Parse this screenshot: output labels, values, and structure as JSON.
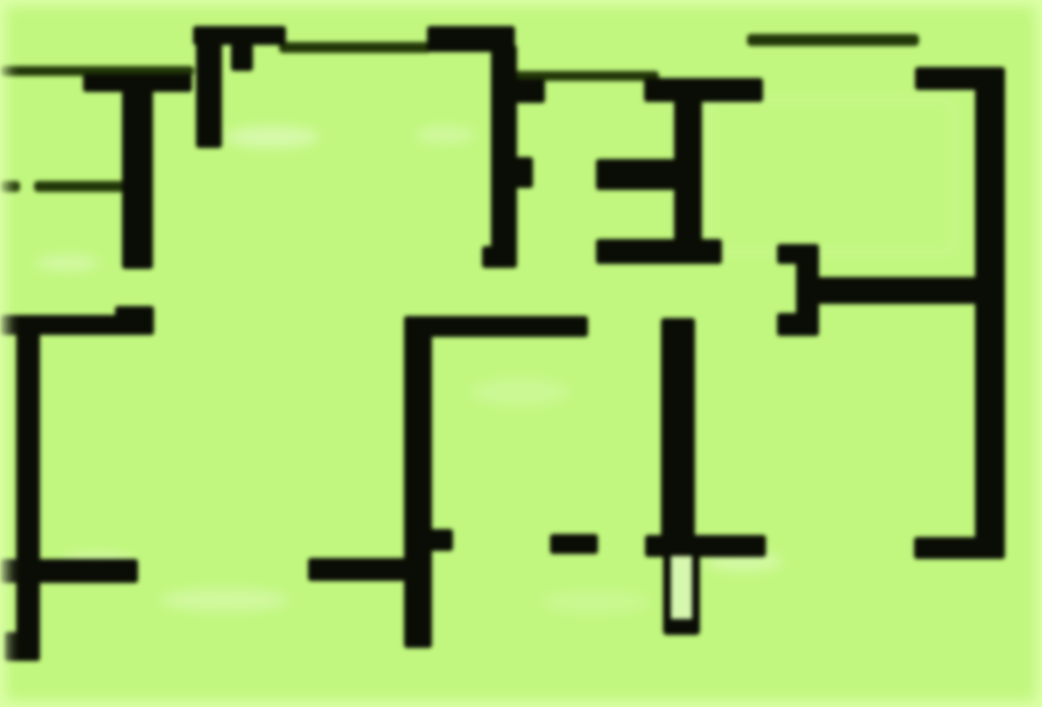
{
  "image": {
    "kind": "floor-plan",
    "description": "Blurred black-wall architectural floor plan on a bright light-green background, no text or labels visible"
  },
  "canvas": {
    "width": 1042,
    "height": 707,
    "background_color": "#c1f77e",
    "edge_glow_color": "#defcac",
    "wall_color": "#0a0d05",
    "thin_wall_color": "#223708",
    "hollow_fill_color": "#d6f7ae"
  },
  "walls_thick": [
    {
      "x": 83,
      "y": 74,
      "w": 109,
      "h": 18
    },
    {
      "x": 122,
      "y": 86,
      "w": 31,
      "h": 183
    },
    {
      "x": 193,
      "y": 26,
      "w": 93,
      "h": 19
    },
    {
      "x": 196,
      "y": 40,
      "w": 26,
      "h": 108
    },
    {
      "x": 231,
      "y": 44,
      "w": 22,
      "h": 27
    },
    {
      "x": 427,
      "y": 26,
      "w": 88,
      "h": 26
    },
    {
      "x": 491,
      "y": 45,
      "w": 26,
      "h": 215
    },
    {
      "x": 513,
      "y": 79,
      "w": 32,
      "h": 24
    },
    {
      "x": 513,
      "y": 157,
      "w": 20,
      "h": 31
    },
    {
      "x": 482,
      "y": 246,
      "w": 35,
      "h": 22
    },
    {
      "x": 644,
      "y": 78,
      "w": 119,
      "h": 24
    },
    {
      "x": 674,
      "y": 96,
      "w": 28,
      "h": 166
    },
    {
      "x": 596,
      "y": 159,
      "w": 80,
      "h": 31
    },
    {
      "x": 596,
      "y": 239,
      "w": 126,
      "h": 25
    },
    {
      "x": 915,
      "y": 67,
      "w": 87,
      "h": 23
    },
    {
      "x": 975,
      "y": 67,
      "w": 30,
      "h": 492
    },
    {
      "x": 914,
      "y": 537,
      "w": 91,
      "h": 22
    },
    {
      "x": 796,
      "y": 244,
      "w": 23,
      "h": 92
    },
    {
      "x": 777,
      "y": 244,
      "w": 25,
      "h": 20
    },
    {
      "x": 777,
      "y": 313,
      "w": 28,
      "h": 23
    },
    {
      "x": 816,
      "y": 277,
      "w": 178,
      "h": 27
    },
    {
      "x": 0,
      "y": 315,
      "w": 154,
      "h": 20
    },
    {
      "x": 115,
      "y": 306,
      "w": 39,
      "h": 29
    },
    {
      "x": 16,
      "y": 324,
      "w": 24,
      "h": 337
    },
    {
      "x": 0,
      "y": 559,
      "w": 138,
      "h": 24
    },
    {
      "x": 4,
      "y": 632,
      "w": 36,
      "h": 29
    },
    {
      "x": 404,
      "y": 316,
      "w": 28,
      "h": 332
    },
    {
      "x": 404,
      "y": 316,
      "w": 184,
      "h": 21
    },
    {
      "x": 428,
      "y": 529,
      "w": 25,
      "h": 22
    },
    {
      "x": 308,
      "y": 558,
      "w": 107,
      "h": 23
    },
    {
      "x": 550,
      "y": 534,
      "w": 48,
      "h": 20
    },
    {
      "x": 661,
      "y": 318,
      "w": 34,
      "h": 234
    },
    {
      "x": 645,
      "y": 535,
      "w": 121,
      "h": 22
    }
  ],
  "walls_thin": [
    {
      "x": 0,
      "y": 66,
      "w": 194,
      "h": 10
    },
    {
      "x": 0,
      "y": 181,
      "w": 20,
      "h": 11
    },
    {
      "x": 34,
      "y": 181,
      "w": 94,
      "h": 11
    },
    {
      "x": 279,
      "y": 42,
      "w": 152,
      "h": 11
    },
    {
      "x": 513,
      "y": 71,
      "w": 146,
      "h": 10
    },
    {
      "x": 747,
      "y": 34,
      "w": 172,
      "h": 12
    }
  ],
  "hollow_features": [
    {
      "x": 663,
      "y": 548,
      "w": 37,
      "h": 87,
      "stroke": 8,
      "bottom_stroke": 16
    }
  ],
  "inset_outlines": [
    {
      "x": 708,
      "y": 98,
      "w": 248,
      "h": 156
    }
  ],
  "smudges": [
    {
      "x": 225,
      "y": 126,
      "w": 95,
      "h": 22,
      "opacity": 0.35
    },
    {
      "x": 415,
      "y": 126,
      "w": 60,
      "h": 18,
      "opacity": 0.25
    },
    {
      "x": 35,
      "y": 255,
      "w": 65,
      "h": 16,
      "opacity": 0.3
    },
    {
      "x": 60,
      "y": 553,
      "w": 75,
      "h": 18,
      "opacity": 0.3
    },
    {
      "x": 705,
      "y": 552,
      "w": 78,
      "h": 20,
      "opacity": 0.3
    },
    {
      "x": 160,
      "y": 588,
      "w": 130,
      "h": 24,
      "opacity": 0.25
    },
    {
      "x": 470,
      "y": 378,
      "w": 100,
      "h": 28,
      "opacity": 0.18
    },
    {
      "x": 540,
      "y": 590,
      "w": 110,
      "h": 24,
      "opacity": 0.15
    }
  ]
}
